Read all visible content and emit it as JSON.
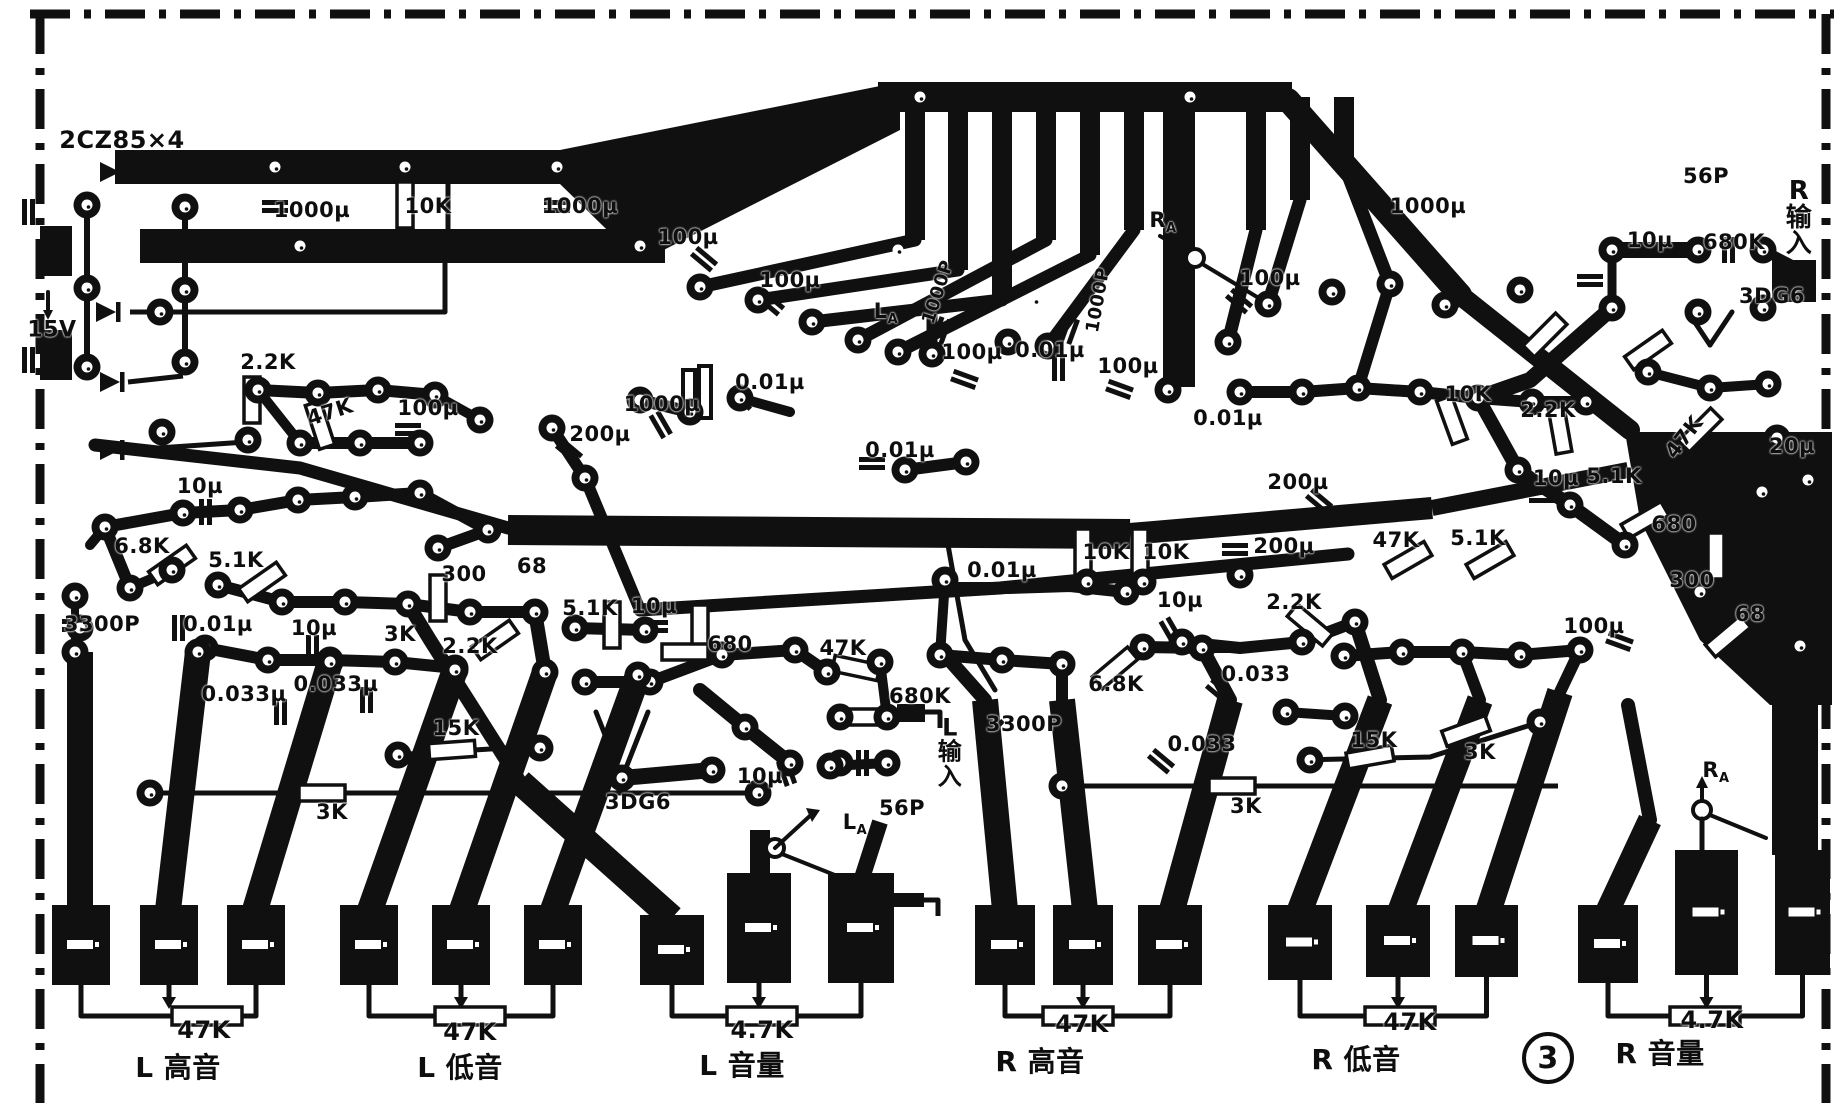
{
  "figure": {
    "badge": "3",
    "description_labels": "printed circuit board layout, stereo tone/volume amplifier"
  },
  "labels": [
    {
      "t": "2CZ85×4",
      "x": 122,
      "y": 140,
      "s": 24
    },
    {
      "t": "15V",
      "x": 52,
      "y": 330,
      "s": 22
    },
    {
      "t": "1000µ",
      "x": 312,
      "y": 210
    },
    {
      "t": "10K",
      "x": 428,
      "y": 206
    },
    {
      "t": "1000µ",
      "x": 580,
      "y": 206
    },
    {
      "t": "100µ",
      "x": 688,
      "y": 237
    },
    {
      "t": "100µ",
      "x": 790,
      "y": 280
    },
    {
      "t": "L",
      "sub": "A",
      "x": 886,
      "y": 313
    },
    {
      "t": "1000P",
      "x": 938,
      "y": 292,
      "r": -72,
      "s": 18
    },
    {
      "t": "100µ",
      "x": 972,
      "y": 352
    },
    {
      "t": "1000P",
      "x": 1098,
      "y": 300,
      "r": -80,
      "s": 18
    },
    {
      "t": "100µ",
      "x": 1128,
      "y": 366
    },
    {
      "t": "R",
      "sub": "A",
      "x": 1163,
      "y": 222
    },
    {
      "t": "1000µ",
      "x": 1428,
      "y": 206
    },
    {
      "t": "100µ",
      "x": 1270,
      "y": 278
    },
    {
      "t": "0.01µ",
      "x": 1050,
      "y": 350
    },
    {
      "t": "0.01µ",
      "x": 1228,
      "y": 418
    },
    {
      "t": "10K",
      "x": 1468,
      "y": 394
    },
    {
      "t": "2.2K",
      "x": 1548,
      "y": 410
    },
    {
      "t": "47K",
      "x": 1684,
      "y": 437,
      "r": -52
    },
    {
      "t": "20µ",
      "x": 1792,
      "y": 446
    },
    {
      "t": "56P",
      "x": 1706,
      "y": 176
    },
    {
      "t": "10µ",
      "x": 1650,
      "y": 240
    },
    {
      "t": "680K",
      "x": 1734,
      "y": 242
    },
    {
      "t": "3DG6",
      "x": 1772,
      "y": 296
    },
    {
      "t": "R输入",
      "x": 1799,
      "y": 218,
      "v": 1,
      "s": 26
    },
    {
      "t": "2.2K",
      "x": 268,
      "y": 362
    },
    {
      "t": "47K",
      "x": 330,
      "y": 412,
      "r": -18
    },
    {
      "t": "100µ",
      "x": 428,
      "y": 408
    },
    {
      "t": "200µ",
      "x": 600,
      "y": 434
    },
    {
      "t": "1000µ",
      "x": 662,
      "y": 404
    },
    {
      "t": "0.01µ",
      "x": 770,
      "y": 382
    },
    {
      "t": "10µ",
      "x": 200,
      "y": 486
    },
    {
      "t": "6.8K",
      "x": 142,
      "y": 546
    },
    {
      "t": "5.1K",
      "x": 236,
      "y": 560
    },
    {
      "t": "300",
      "x": 464,
      "y": 574
    },
    {
      "t": "68",
      "x": 532,
      "y": 566
    },
    {
      "t": "3300P",
      "x": 102,
      "y": 624
    },
    {
      "t": "0.01µ",
      "x": 218,
      "y": 624
    },
    {
      "t": "10µ",
      "x": 314,
      "y": 628
    },
    {
      "t": "3K",
      "x": 400,
      "y": 634
    },
    {
      "t": "2.2K",
      "x": 470,
      "y": 646
    },
    {
      "t": "0.033µ",
      "x": 244,
      "y": 694
    },
    {
      "t": "0.033µ",
      "x": 336,
      "y": 684
    },
    {
      "t": "15K",
      "x": 456,
      "y": 728
    },
    {
      "t": "3K",
      "x": 332,
      "y": 812
    },
    {
      "t": "5.1K",
      "x": 590,
      "y": 608
    },
    {
      "t": "10µ",
      "x": 654,
      "y": 606
    },
    {
      "t": "680",
      "x": 730,
      "y": 644
    },
    {
      "t": "47K",
      "x": 843,
      "y": 648
    },
    {
      "t": "680K",
      "x": 920,
      "y": 696
    },
    {
      "t": "L输入",
      "x": 950,
      "y": 752,
      "v": 1,
      "s": 24
    },
    {
      "t": "56P",
      "x": 902,
      "y": 808
    },
    {
      "t": "10µ",
      "x": 760,
      "y": 776
    },
    {
      "t": "3DG6",
      "x": 638,
      "y": 802
    },
    {
      "t": "L",
      "sub": "A",
      "x": 855,
      "y": 824
    },
    {
      "t": "0.01µ",
      "x": 900,
      "y": 450
    },
    {
      "t": "10K",
      "x": 1106,
      "y": 552
    },
    {
      "t": "10K",
      "x": 1166,
      "y": 552
    },
    {
      "t": "200µ",
      "x": 1298,
      "y": 482
    },
    {
      "t": "200µ",
      "x": 1284,
      "y": 546
    },
    {
      "t": "0.01µ",
      "x": 1002,
      "y": 570
    },
    {
      "t": "10µ",
      "x": 1180,
      "y": 600
    },
    {
      "t": "2.2K",
      "x": 1294,
      "y": 602
    },
    {
      "t": "47K",
      "x": 1396,
      "y": 540
    },
    {
      "t": "5.1K",
      "x": 1478,
      "y": 538
    },
    {
      "t": "6.8K",
      "x": 1116,
      "y": 684
    },
    {
      "t": "0.033",
      "x": 1256,
      "y": 674
    },
    {
      "t": "3300P",
      "x": 1024,
      "y": 724
    },
    {
      "t": "0.033",
      "x": 1202,
      "y": 744
    },
    {
      "t": "15K",
      "x": 1374,
      "y": 740
    },
    {
      "t": "3K",
      "x": 1480,
      "y": 752
    },
    {
      "t": "3K",
      "x": 1246,
      "y": 806
    },
    {
      "t": "300",
      "x": 1692,
      "y": 580
    },
    {
      "t": "68",
      "x": 1750,
      "y": 614
    },
    {
      "t": "100µ",
      "x": 1594,
      "y": 626
    },
    {
      "t": "10µ",
      "x": 1556,
      "y": 478
    },
    {
      "t": "5.1K",
      "x": 1614,
      "y": 476
    },
    {
      "t": "680",
      "x": 1674,
      "y": 524
    },
    {
      "t": "R",
      "sub": "A",
      "x": 1716,
      "y": 772
    },
    {
      "t": "47K",
      "x": 204,
      "y": 1030,
      "s": 24
    },
    {
      "t": "L 高音",
      "x": 178,
      "y": 1066,
      "s": 28
    },
    {
      "t": "47K",
      "x": 470,
      "y": 1032,
      "s": 24
    },
    {
      "t": "L 低音",
      "x": 460,
      "y": 1066,
      "s": 28
    },
    {
      "t": "4.7K",
      "x": 762,
      "y": 1030,
      "s": 24
    },
    {
      "t": "L 音量",
      "x": 742,
      "y": 1064,
      "s": 28
    },
    {
      "t": "47K",
      "x": 1082,
      "y": 1024,
      "s": 24
    },
    {
      "t": "R 高音",
      "x": 1040,
      "y": 1060,
      "s": 28
    },
    {
      "t": "47K",
      "x": 1410,
      "y": 1022,
      "s": 24
    },
    {
      "t": "R 低音",
      "x": 1356,
      "y": 1058,
      "s": 28
    },
    {
      "t": "4.7K",
      "x": 1712,
      "y": 1020,
      "s": 24
    },
    {
      "t": "R 音量",
      "x": 1660,
      "y": 1052,
      "s": 28
    },
    {
      "t": "3",
      "x": 1548,
      "y": 1058,
      "c": 1,
      "s": 30
    }
  ]
}
